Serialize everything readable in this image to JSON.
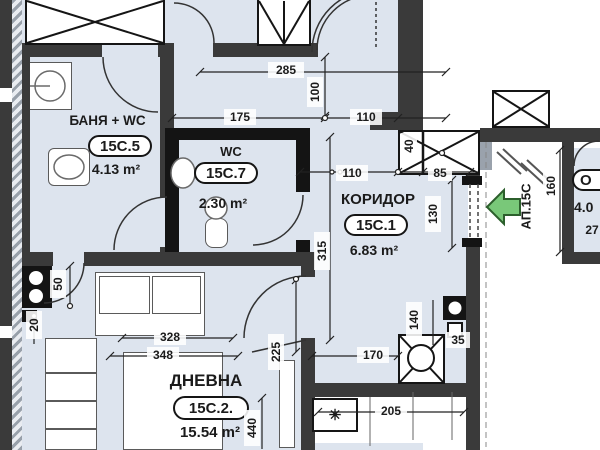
{
  "plan": {
    "apartment_label": "АП.15С",
    "rooms": {
      "bathroom": {
        "name": "БАНЯ + WC",
        "code": "15С.5",
        "area": "4.13 m²"
      },
      "wc": {
        "name": "WC",
        "code": "15С.7",
        "area": "2.30 m²"
      },
      "corridor": {
        "name": "КОРИДОР",
        "code": "15С.1",
        "area": "6.83 m²"
      },
      "living": {
        "name": "ДНЕВНА",
        "code": "15С.2.",
        "area": "15.54 m²"
      },
      "neighbor": {
        "code_partial": "О",
        "area_partial": "4.0",
        "dim_partial": "27"
      }
    },
    "dimensions": {
      "d285": "285",
      "d100": "100",
      "d175": "175",
      "d110_top": "110",
      "d110_mid": "110",
      "d85": "85",
      "d40": "40",
      "d130": "130",
      "d315": "315",
      "d160": "160",
      "d170": "170",
      "d140": "140",
      "d35": "35",
      "d205": "205",
      "d328": "328",
      "d348": "348",
      "d225": "225",
      "d440": "440",
      "d50": "50",
      "d20": "20"
    },
    "symbols": {
      "radiator": "✳"
    },
    "colors": {
      "floor": "#dde4ee",
      "wall": "#3a3a3a",
      "arrow_green": "#79c879"
    }
  }
}
